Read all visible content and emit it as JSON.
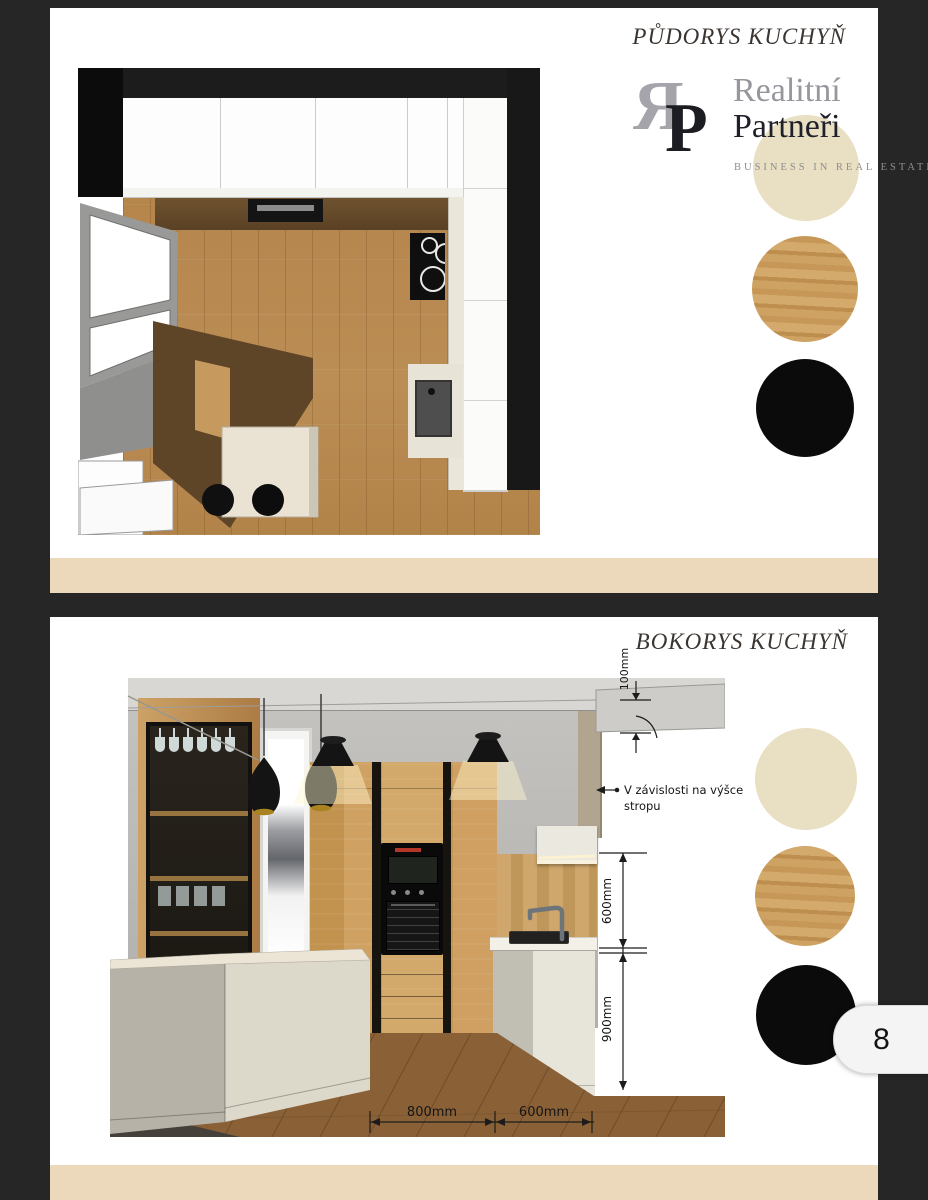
{
  "colors": {
    "background": "#262626",
    "beige_strip": "#ecd9bc",
    "swatch_cream": "#e9dfc2",
    "swatch_wood": "#c49455",
    "swatch_black": "#0b0b0b"
  },
  "page1": {
    "title": "PŮDORYS KUCHYŇ",
    "logo": {
      "mono_r": "Я",
      "mono_p": "P",
      "word1": "Realitní",
      "word2": "Partneři",
      "tagline": "BUSINESS IN REAL ESTATE"
    },
    "swatches": [
      {
        "name": "cream",
        "color": "#e9dfc2"
      },
      {
        "name": "oak-wood",
        "color": "#c49455"
      },
      {
        "name": "black",
        "color": "#0b0b0b"
      }
    ]
  },
  "page2": {
    "title": "BOKORYS KUCHYŇ",
    "note_line1": "V závislosti na výšce",
    "note_line2": "stropu",
    "dimensions": {
      "soffit_height": "100mm",
      "splash_height": "600mm",
      "base_height": "900mm",
      "island_gap": "800mm",
      "cabinet_depth": "600mm"
    }
  },
  "page_indicator": "8"
}
